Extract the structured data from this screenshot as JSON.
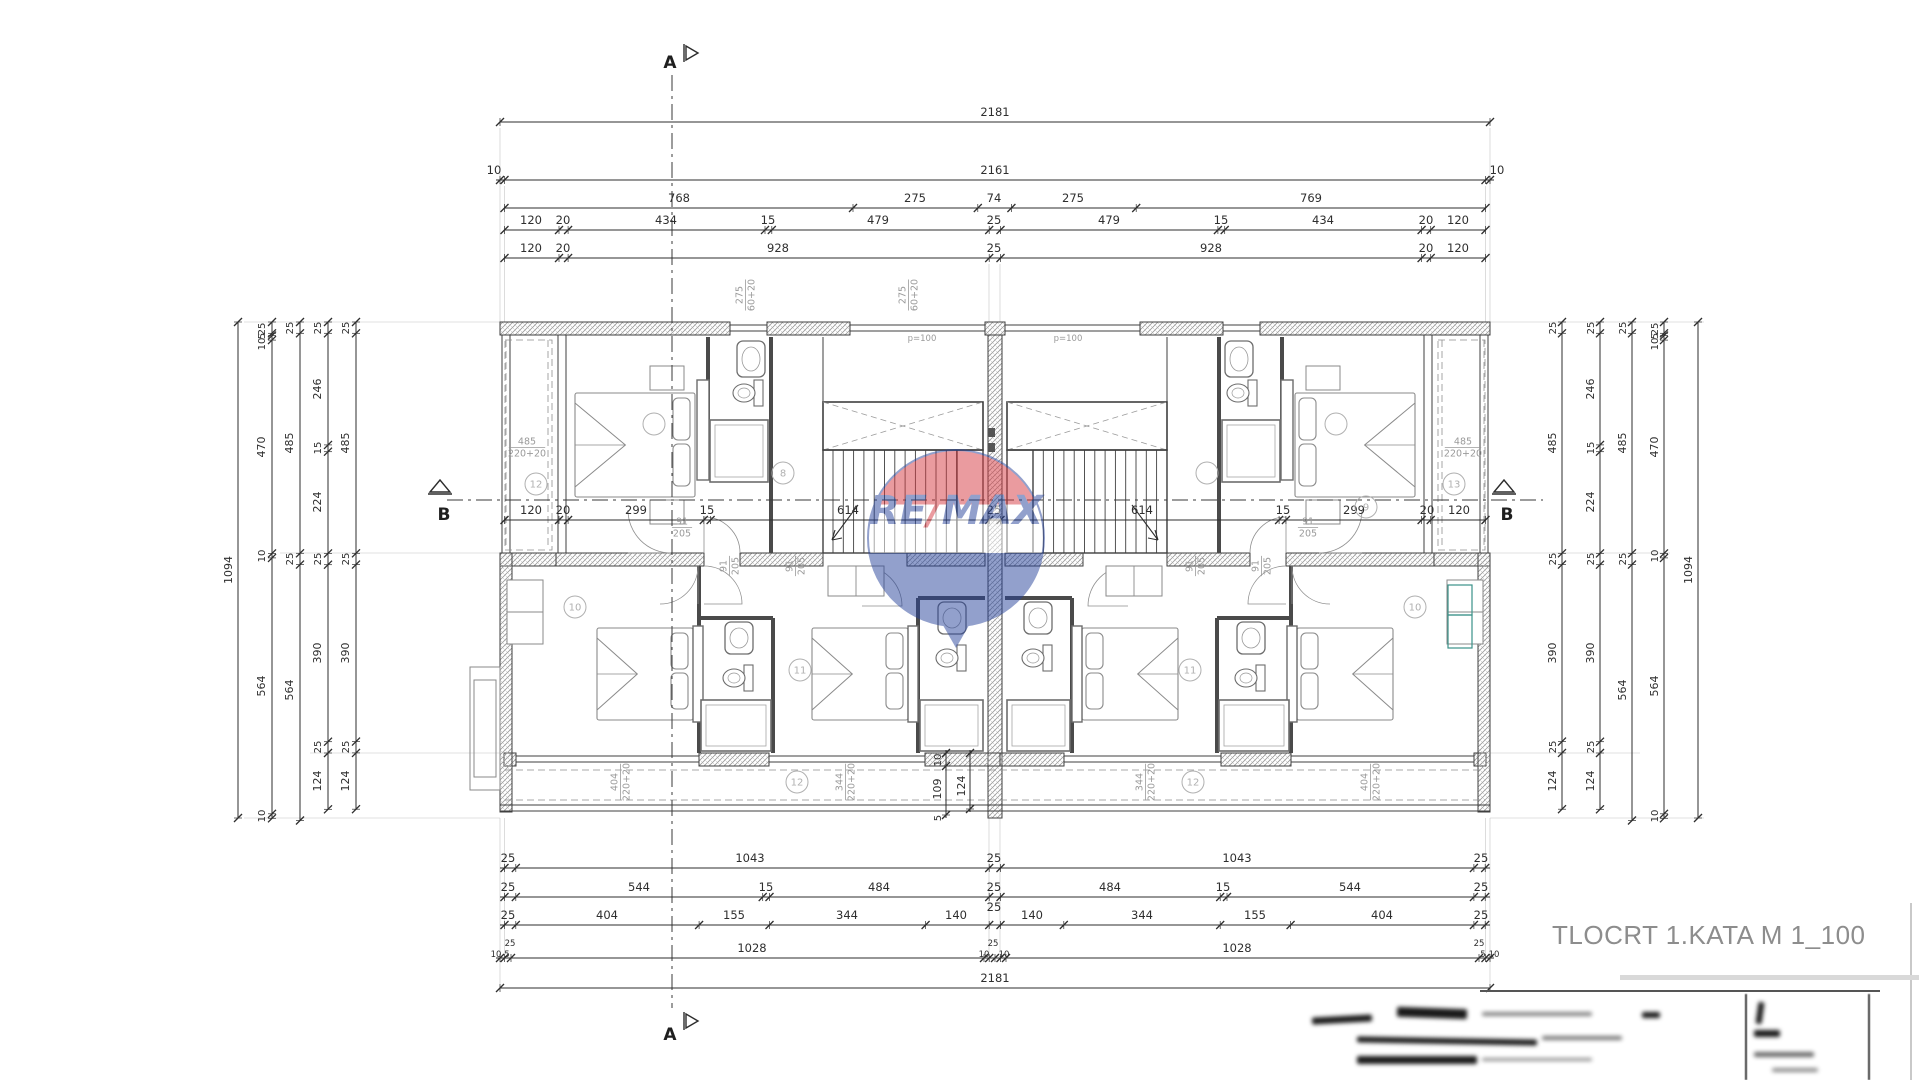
{
  "title": "TLOCRT 1.KATA M 1_100",
  "watermark": {
    "re": "RE",
    "slash": "/",
    "max": "MAX",
    "red": "#d63a41",
    "blue": "#27439b"
  },
  "colors": {
    "line": "#3f3f3f",
    "dim": "#2e2e2e",
    "gray_label": "#9a9a9a",
    "hatch": "#9a9a9a",
    "teal": "#3a9188"
  },
  "markers": [
    {
      "t": "A",
      "x": 662,
      "y": 68
    },
    {
      "t": "A",
      "x": 662,
      "y": 1040
    },
    {
      "t": "B",
      "x": 436,
      "y": 520
    },
    {
      "t": "B",
      "x": 1499,
      "y": 520
    }
  ],
  "dim_labels": [
    {
      "t": "2181",
      "x": 995,
      "y": 116
    },
    {
      "t": "10",
      "x": 494,
      "y": 174
    },
    {
      "t": "2161",
      "x": 995,
      "y": 174
    },
    {
      "t": "10",
      "x": 1497,
      "y": 174
    },
    {
      "t": "768",
      "x": 679,
      "y": 202
    },
    {
      "t": "275",
      "x": 915,
      "y": 202
    },
    {
      "t": "74",
      "x": 994,
      "y": 202
    },
    {
      "t": "275",
      "x": 1073,
      "y": 202
    },
    {
      "t": "769",
      "x": 1311,
      "y": 202
    },
    {
      "t": "120",
      "x": 531,
      "y": 224
    },
    {
      "t": "20",
      "x": 563,
      "y": 224
    },
    {
      "t": "434",
      "x": 666,
      "y": 224
    },
    {
      "t": "15",
      "x": 768,
      "y": 224
    },
    {
      "t": "479",
      "x": 878,
      "y": 224
    },
    {
      "t": "25",
      "x": 994,
      "y": 224
    },
    {
      "t": "479",
      "x": 1109,
      "y": 224
    },
    {
      "t": "15",
      "x": 1221,
      "y": 224
    },
    {
      "t": "434",
      "x": 1323,
      "y": 224
    },
    {
      "t": "20",
      "x": 1426,
      "y": 224
    },
    {
      "t": "120",
      "x": 1458,
      "y": 224
    },
    {
      "t": "120",
      "x": 531,
      "y": 252
    },
    {
      "t": "20",
      "x": 563,
      "y": 252
    },
    {
      "t": "928",
      "x": 778,
      "y": 252
    },
    {
      "t": "25",
      "x": 994,
      "y": 252
    },
    {
      "t": "928",
      "x": 1211,
      "y": 252
    },
    {
      "t": "20",
      "x": 1426,
      "y": 252
    },
    {
      "t": "120",
      "x": 1458,
      "y": 252
    },
    {
      "t": "120",
      "x": 531,
      "y": 514
    },
    {
      "t": "20",
      "x": 563,
      "y": 514
    },
    {
      "t": "299",
      "x": 636,
      "y": 514
    },
    {
      "t": "15",
      "x": 707,
      "y": 514
    },
    {
      "t": "614",
      "x": 848,
      "y": 514
    },
    {
      "t": "25",
      "x": 994,
      "y": 514
    },
    {
      "t": "614",
      "x": 1142,
      "y": 514
    },
    {
      "t": "15",
      "x": 1283,
      "y": 514
    },
    {
      "t": "299",
      "x": 1354,
      "y": 514
    },
    {
      "t": "20",
      "x": 1427,
      "y": 514
    },
    {
      "t": "120",
      "x": 1459,
      "y": 514
    },
    {
      "t": "25",
      "x": 508,
      "y": 862
    },
    {
      "t": "1043",
      "x": 750,
      "y": 862
    },
    {
      "t": "25",
      "x": 994,
      "y": 862
    },
    {
      "t": "1043",
      "x": 1237,
      "y": 862
    },
    {
      "t": "25",
      "x": 1481,
      "y": 862
    },
    {
      "t": "25",
      "x": 508,
      "y": 891
    },
    {
      "t": "544",
      "x": 639,
      "y": 891
    },
    {
      "t": "15",
      "x": 766,
      "y": 891
    },
    {
      "t": "484",
      "x": 879,
      "y": 891
    },
    {
      "t": "25",
      "x": 994,
      "y": 891
    },
    {
      "t": "484",
      "x": 1110,
      "y": 891
    },
    {
      "t": "15",
      "x": 1223,
      "y": 891
    },
    {
      "t": "544",
      "x": 1350,
      "y": 891
    },
    {
      "t": "25",
      "x": 1481,
      "y": 891
    },
    {
      "t": "25",
      "x": 508,
      "y": 919
    },
    {
      "t": "404",
      "x": 607,
      "y": 919
    },
    {
      "t": "155",
      "x": 734,
      "y": 919
    },
    {
      "t": "344",
      "x": 847,
      "y": 919
    },
    {
      "t": "140",
      "x": 956,
      "y": 919
    },
    {
      "t": "25",
      "x": 994,
      "y": 911
    },
    {
      "t": "140",
      "x": 1032,
      "y": 919
    },
    {
      "t": "344",
      "x": 1142,
      "y": 919
    },
    {
      "t": "155",
      "x": 1255,
      "y": 919
    },
    {
      "t": "404",
      "x": 1382,
      "y": 919
    },
    {
      "t": "25",
      "x": 1481,
      "y": 919
    },
    {
      "t": "1028",
      "x": 752,
      "y": 952
    },
    {
      "t": "1028",
      "x": 1237,
      "y": 952
    },
    {
      "t": "2181",
      "x": 995,
      "y": 982
    }
  ],
  "tiny_dim_labels": [
    {
      "t": "25",
      "x": 510,
      "y": 946
    },
    {
      "t": "25",
      "x": 993,
      "y": 946
    },
    {
      "t": "25",
      "x": 1479,
      "y": 946
    },
    {
      "t": "10",
      "x": 496,
      "y": 957
    },
    {
      "t": "5",
      "x": 507,
      "y": 957
    },
    {
      "t": "10",
      "x": 984,
      "y": 957
    },
    {
      "t": "10",
      "x": 1004,
      "y": 957
    },
    {
      "t": "5",
      "x": 1483,
      "y": 957
    },
    {
      "t": "10",
      "x": 1494,
      "y": 957
    }
  ],
  "vdim_labels": [
    {
      "t": "1094",
      "x": 232,
      "y": 570
    },
    {
      "t": "25",
      "x": 265,
      "y": 329
    },
    {
      "t": "5",
      "x": 265,
      "y": 336
    },
    {
      "t": "10",
      "x": 265,
      "y": 344
    },
    {
      "t": "470",
      "x": 265,
      "y": 447
    },
    {
      "t": "10",
      "x": 265,
      "y": 556
    },
    {
      "t": "564",
      "x": 265,
      "y": 686
    },
    {
      "t": "10",
      "x": 265,
      "y": 816
    },
    {
      "t": "25",
      "x": 293,
      "y": 328
    },
    {
      "t": "485",
      "x": 293,
      "y": 443
    },
    {
      "t": "25",
      "x": 293,
      "y": 559
    },
    {
      "t": "564",
      "x": 293,
      "y": 690
    },
    {
      "t": "25",
      "x": 321,
      "y": 328
    },
    {
      "t": "246",
      "x": 321,
      "y": 389
    },
    {
      "t": "15",
      "x": 321,
      "y": 448
    },
    {
      "t": "224",
      "x": 321,
      "y": 502
    },
    {
      "t": "25",
      "x": 321,
      "y": 559
    },
    {
      "t": "390",
      "x": 321,
      "y": 653
    },
    {
      "t": "25",
      "x": 321,
      "y": 747
    },
    {
      "t": "124",
      "x": 321,
      "y": 781
    },
    {
      "t": "25",
      "x": 349,
      "y": 328
    },
    {
      "t": "485",
      "x": 349,
      "y": 443
    },
    {
      "t": "25",
      "x": 349,
      "y": 559
    },
    {
      "t": "390",
      "x": 349,
      "y": 653
    },
    {
      "t": "25",
      "x": 349,
      "y": 747
    },
    {
      "t": "124",
      "x": 349,
      "y": 781
    },
    {
      "t": "25",
      "x": 1556,
      "y": 328
    },
    {
      "t": "485",
      "x": 1556,
      "y": 443
    },
    {
      "t": "25",
      "x": 1556,
      "y": 559
    },
    {
      "t": "390",
      "x": 1556,
      "y": 653
    },
    {
      "t": "25",
      "x": 1556,
      "y": 747
    },
    {
      "t": "124",
      "x": 1556,
      "y": 781
    },
    {
      "t": "25",
      "x": 1594,
      "y": 328
    },
    {
      "t": "246",
      "x": 1594,
      "y": 389
    },
    {
      "t": "15",
      "x": 1594,
      "y": 448
    },
    {
      "t": "224",
      "x": 1594,
      "y": 502
    },
    {
      "t": "25",
      "x": 1594,
      "y": 559
    },
    {
      "t": "390",
      "x": 1594,
      "y": 653
    },
    {
      "t": "25",
      "x": 1594,
      "y": 747
    },
    {
      "t": "124",
      "x": 1594,
      "y": 781
    },
    {
      "t": "25",
      "x": 1626,
      "y": 328
    },
    {
      "t": "485",
      "x": 1626,
      "y": 443
    },
    {
      "t": "25",
      "x": 1626,
      "y": 559
    },
    {
      "t": "564",
      "x": 1626,
      "y": 690
    },
    {
      "t": "25",
      "x": 1658,
      "y": 329
    },
    {
      "t": "5",
      "x": 1658,
      "y": 336
    },
    {
      "t": "10",
      "x": 1658,
      "y": 344
    },
    {
      "t": "470",
      "x": 1658,
      "y": 447
    },
    {
      "t": "10",
      "x": 1658,
      "y": 556
    },
    {
      "t": "564",
      "x": 1658,
      "y": 686
    },
    {
      "t": "10",
      "x": 1658,
      "y": 816
    },
    {
      "t": "1094",
      "x": 1692,
      "y": 570
    },
    {
      "t": "10",
      "x": 941,
      "y": 760
    },
    {
      "t": "109",
      "x": 941,
      "y": 789
    },
    {
      "t": "124",
      "x": 965,
      "y": 786
    },
    {
      "t": "5",
      "x": 941,
      "y": 818
    }
  ],
  "frac_labels": [
    {
      "top": "485",
      "bot": "220+20",
      "x": 527,
      "y": 447,
      "rot": 0
    },
    {
      "top": "485",
      "bot": "220+20",
      "x": 1463,
      "y": 447,
      "rot": 0
    },
    {
      "top": "275",
      "bot": "60+20",
      "x": 745,
      "y": 295,
      "rot": -90
    },
    {
      "top": "275",
      "bot": "60+20",
      "x": 908,
      "y": 295,
      "rot": -90
    },
    {
      "top": "404",
      "bot": "220+20",
      "x": 620,
      "y": 782,
      "rot": -90
    },
    {
      "top": "344",
      "bot": "220+20",
      "x": 845,
      "y": 782,
      "rot": -90
    },
    {
      "top": "344",
      "bot": "220+20",
      "x": 1145,
      "y": 782,
      "rot": -90
    },
    {
      "top": "404",
      "bot": "220+20",
      "x": 1370,
      "y": 782,
      "rot": -90
    },
    {
      "top": "91",
      "bot": "205",
      "x": 729,
      "y": 566,
      "rot": -90
    },
    {
      "top": "91",
      "bot": "205",
      "x": 795,
      "y": 566,
      "rot": -90
    },
    {
      "top": "91",
      "bot": "205",
      "x": 1195,
      "y": 566,
      "rot": -90
    },
    {
      "top": "91",
      "bot": "205",
      "x": 1261,
      "y": 566,
      "rot": -90
    },
    {
      "top": "91",
      "bot": "205",
      "x": 682,
      "y": 527,
      "rot": 0
    },
    {
      "top": "91",
      "bot": "205",
      "x": 1308,
      "y": 527,
      "rot": 0
    }
  ],
  "small_labels": [
    {
      "t": "p=100",
      "x": 922,
      "y": 341
    },
    {
      "t": "p=100",
      "x": 1068,
      "y": 341
    }
  ],
  "room_circles": [
    {
      "n": "12",
      "x": 536,
      "y": 484
    },
    {
      "n": "",
      "x": 654,
      "y": 424
    },
    {
      "n": "8",
      "x": 783,
      "y": 473
    },
    {
      "n": "",
      "x": 1207,
      "y": 473
    },
    {
      "n": "",
      "x": 1336,
      "y": 424
    },
    {
      "n": "9",
      "x": 1366,
      "y": 507
    },
    {
      "n": "13",
      "x": 1454,
      "y": 484
    },
    {
      "n": "10",
      "x": 575,
      "y": 607
    },
    {
      "n": "11",
      "x": 800,
      "y": 670
    },
    {
      "n": "11",
      "x": 1190,
      "y": 670
    },
    {
      "n": "10",
      "x": 1415,
      "y": 607
    },
    {
      "n": "12",
      "x": 797,
      "y": 782
    },
    {
      "n": "12",
      "x": 1193,
      "y": 782
    }
  ]
}
